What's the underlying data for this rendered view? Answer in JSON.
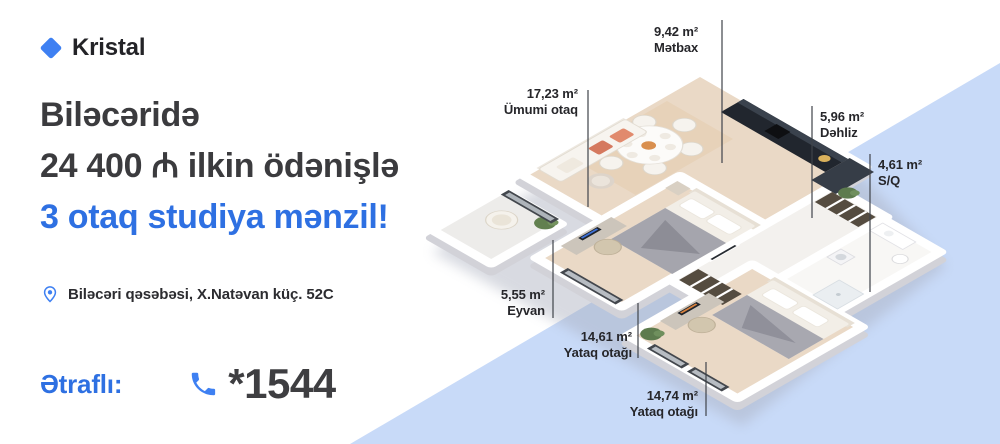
{
  "brand": {
    "name": "Kristal",
    "logo_icon": "diamond-icon"
  },
  "headline": {
    "line1": "Biləcəridə",
    "line2": "24 400 ₼ ilkin ödənişlə",
    "line3": "3 otaq studiya mənzil!"
  },
  "location": {
    "icon": "location-pin-icon",
    "text": "Biləcəri qəsəbəsi, X.Natəvan küç. 52C"
  },
  "contact": {
    "label": "Ətraflı:",
    "icon": "phone-icon",
    "phone": "*1544"
  },
  "colors": {
    "accent_text": "#2e70e2",
    "accent_icon": "#3e80f2",
    "dark": "#3b3b3e",
    "wedge": "#c8daf8"
  },
  "floorplan": {
    "rooms": [
      {
        "area": "9,42 m²",
        "name": "Mətbax"
      },
      {
        "area": "17,23 m²",
        "name": "Ümumi otaq"
      },
      {
        "area": "5,96 m²",
        "name": "Dəhliz"
      },
      {
        "area": "4,61 m²",
        "name": "S/Q"
      },
      {
        "area": "5,55 m²",
        "name": "Eyvan"
      },
      {
        "area": "14,61 m²",
        "name": "Yataq otağı"
      },
      {
        "area": "14,74 m²",
        "name": "Yataq otağı"
      }
    ]
  }
}
